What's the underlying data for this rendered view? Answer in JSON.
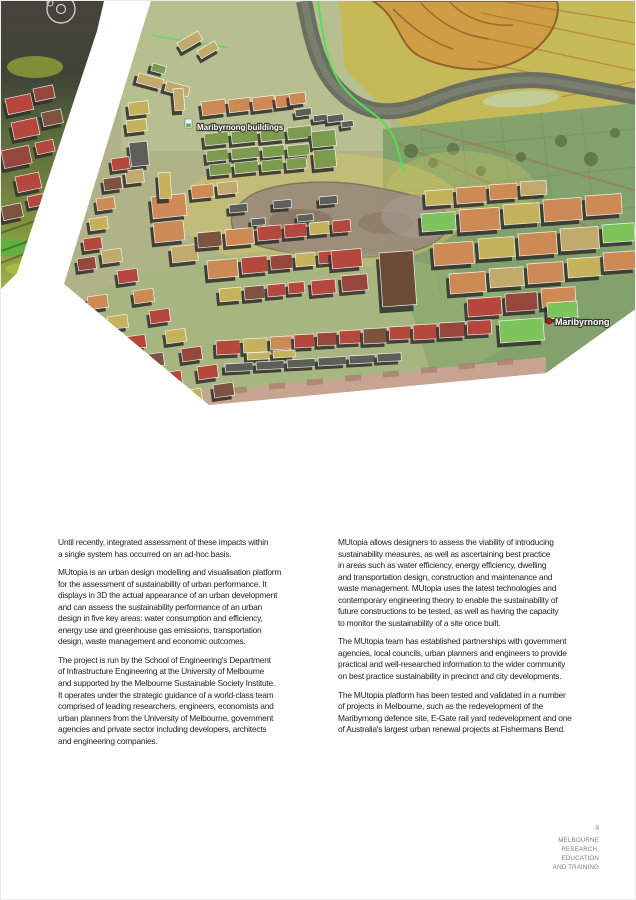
{
  "hero": {
    "labels": [
      {
        "text": "Maribyrnong buildings",
        "x": 196,
        "y": 129,
        "size": 8,
        "icon": "buildings-layer-icon",
        "ix": 184,
        "iy": 118
      },
      {
        "text": "Maribyrnong",
        "x": 554,
        "y": 324,
        "size": 9,
        "icon": "placemark-dot-icon",
        "ix": 548,
        "iy": 320
      }
    ],
    "palette": {
      "or": "#cd8a55",
      "or2": "#d89a66",
      "gr": "#7d9b4f",
      "bg": "#7cc45b",
      "yl": "#c6b25c",
      "rd": "#b5473d",
      "mr": "#94473a",
      "br": "#7d5340",
      "db": "#6b4a38",
      "gy": "#5c5e58",
      "tn": "#c2a96c"
    },
    "buildings": [
      [
        176,
        42,
        24,
        10,
        "tn",
        -30
      ],
      [
        196,
        50,
        20,
        9,
        "tn",
        -30
      ],
      [
        152,
        62,
        14,
        8,
        "gr",
        15
      ],
      [
        138,
        72,
        26,
        10,
        "tn",
        15
      ],
      [
        166,
        80,
        24,
        10,
        "tn",
        15
      ],
      [
        172,
        88,
        10,
        22,
        "tn",
        -5
      ],
      [
        200,
        101,
        24,
        14,
        "or",
        -7
      ],
      [
        227,
        99,
        22,
        13,
        "or",
        -7
      ],
      [
        251,
        97,
        22,
        13,
        "or",
        -7
      ],
      [
        274,
        95,
        20,
        12,
        "or",
        -7
      ],
      [
        288,
        93,
        16,
        11,
        "or",
        -7
      ],
      [
        294,
        109,
        16,
        7,
        "gy",
        -8
      ],
      [
        312,
        115,
        14,
        6,
        "gy",
        -8
      ],
      [
        326,
        115,
        16,
        7,
        "gy",
        -8
      ],
      [
        340,
        121,
        12,
        6,
        "gy",
        -8
      ],
      [
        203,
        133,
        24,
        12,
        "gr",
        -6
      ],
      [
        230,
        131,
        26,
        12,
        "gr",
        -6
      ],
      [
        259,
        129,
        24,
        12,
        "gr",
        -6
      ],
      [
        286,
        127,
        24,
        12,
        "gr",
        -6
      ],
      [
        310,
        131,
        24,
        16,
        "gr",
        -6
      ],
      [
        205,
        150,
        22,
        11,
        "gr",
        -6
      ],
      [
        230,
        148,
        28,
        11,
        "gr",
        -6
      ],
      [
        261,
        146,
        22,
        11,
        "gr",
        -6
      ],
      [
        286,
        145,
        22,
        11,
        "gr",
        -6
      ],
      [
        312,
        150,
        22,
        18,
        "gr",
        -6
      ],
      [
        208,
        164,
        22,
        11,
        "gr",
        -6
      ],
      [
        233,
        162,
        24,
        11,
        "gr",
        -6
      ],
      [
        260,
        160,
        22,
        11,
        "gr",
        -6
      ],
      [
        285,
        158,
        20,
        11,
        "gr",
        -6
      ],
      [
        127,
        102,
        20,
        13,
        "yl",
        -7
      ],
      [
        125,
        120,
        20,
        12,
        "yl",
        -7
      ],
      [
        128,
        142,
        18,
        24,
        "gy",
        -6
      ],
      [
        124,
        170,
        18,
        13,
        "tn",
        -7
      ],
      [
        150,
        196,
        34,
        22,
        "or",
        -6
      ],
      [
        152,
        222,
        30,
        20,
        "or",
        -6
      ],
      [
        157,
        172,
        12,
        26,
        "yl",
        -4
      ],
      [
        170,
        246,
        26,
        16,
        "tn",
        -6
      ],
      [
        190,
        185,
        22,
        13,
        "or",
        -6
      ],
      [
        216,
        182,
        20,
        12,
        "tn",
        -6
      ],
      [
        110,
        158,
        18,
        12,
        "rd",
        -8
      ],
      [
        102,
        178,
        18,
        12,
        "br",
        -8
      ],
      [
        95,
        198,
        18,
        12,
        "or",
        -8
      ],
      [
        88,
        218,
        18,
        12,
        "yl",
        -8
      ],
      [
        82,
        238,
        18,
        12,
        "rd",
        -8
      ],
      [
        76,
        258,
        18,
        12,
        "mr",
        -8
      ],
      [
        86,
        296,
        20,
        13,
        "or",
        -8
      ],
      [
        106,
        316,
        20,
        13,
        "yl",
        -8
      ],
      [
        124,
        336,
        20,
        13,
        "rd",
        -8
      ],
      [
        142,
        354,
        20,
        13,
        "br",
        -8
      ],
      [
        160,
        372,
        20,
        13,
        "rd",
        -8
      ],
      [
        180,
        390,
        20,
        13,
        "yl",
        -8
      ],
      [
        100,
        250,
        20,
        13,
        "tn",
        -8
      ],
      [
        116,
        270,
        20,
        13,
        "rd",
        -8
      ],
      [
        132,
        290,
        20,
        13,
        "or",
        -8
      ],
      [
        148,
        310,
        20,
        13,
        "rd",
        -8
      ],
      [
        164,
        330,
        20,
        13,
        "yl",
        -8
      ],
      [
        180,
        348,
        20,
        13,
        "mr",
        -8
      ],
      [
        196,
        366,
        20,
        13,
        "rd",
        -8
      ],
      [
        212,
        384,
        20,
        13,
        "br",
        -8
      ],
      [
        228,
        204,
        18,
        8,
        "gy",
        -5
      ],
      [
        272,
        200,
        18,
        8,
        "gy",
        -5
      ],
      [
        318,
        196,
        18,
        8,
        "gy",
        -5
      ],
      [
        250,
        218,
        14,
        7,
        "gy",
        -5
      ],
      [
        296,
        214,
        16,
        7,
        "gy",
        -5
      ],
      [
        196,
        232,
        24,
        15,
        "br",
        -5
      ],
      [
        224,
        229,
        28,
        16,
        "or",
        -5
      ],
      [
        256,
        226,
        24,
        14,
        "rd",
        -5
      ],
      [
        283,
        224,
        22,
        13,
        "rd",
        -5
      ],
      [
        308,
        222,
        20,
        12,
        "yl",
        -5
      ],
      [
        331,
        220,
        18,
        12,
        "rd",
        -5
      ],
      [
        206,
        260,
        30,
        18,
        "or",
        -5
      ],
      [
        240,
        257,
        26,
        16,
        "rd",
        -5
      ],
      [
        269,
        255,
        22,
        14,
        "mr",
        -5
      ],
      [
        294,
        253,
        20,
        13,
        "yl",
        -5
      ],
      [
        317,
        251,
        18,
        12,
        "rd",
        -5
      ],
      [
        218,
        288,
        22,
        13,
        "yl",
        -5
      ],
      [
        243,
        286,
        20,
        13,
        "br",
        -5
      ],
      [
        266,
        284,
        18,
        12,
        "rd",
        -5
      ],
      [
        287,
        282,
        16,
        11,
        "rd",
        -5
      ],
      [
        330,
        250,
        30,
        18,
        "rd",
        -5
      ],
      [
        340,
        275,
        26,
        16,
        "mr",
        -5
      ],
      [
        310,
        280,
        24,
        14,
        "rd",
        -5
      ],
      [
        378,
        252,
        34,
        54,
        "db",
        -4
      ],
      [
        424,
        190,
        28,
        15,
        "yl",
        -4
      ],
      [
        455,
        187,
        30,
        16,
        "or",
        -4
      ],
      [
        488,
        184,
        28,
        15,
        "or",
        -4
      ],
      [
        519,
        181,
        26,
        14,
        "tn",
        -4
      ],
      [
        420,
        213,
        34,
        18,
        "bg",
        -4
      ],
      [
        458,
        209,
        40,
        22,
        "or",
        -4
      ],
      [
        502,
        204,
        36,
        20,
        "yl",
        -4
      ],
      [
        542,
        199,
        38,
        22,
        "or",
        -4
      ],
      [
        584,
        195,
        36,
        20,
        "or",
        -4
      ],
      [
        432,
        243,
        40,
        22,
        "or",
        -4
      ],
      [
        477,
        238,
        36,
        20,
        "yl",
        -4
      ],
      [
        517,
        233,
        38,
        22,
        "or",
        -4
      ],
      [
        559,
        228,
        38,
        22,
        "tn",
        -4
      ],
      [
        601,
        224,
        32,
        18,
        "bg",
        -4
      ],
      [
        448,
        273,
        36,
        20,
        "or",
        -4
      ],
      [
        488,
        268,
        34,
        19,
        "tn",
        -4
      ],
      [
        526,
        263,
        36,
        20,
        "or",
        -4
      ],
      [
        566,
        258,
        34,
        19,
        "yl",
        -4
      ],
      [
        602,
        252,
        32,
        18,
        "or",
        -4
      ],
      [
        466,
        298,
        34,
        18,
        "rd",
        -4
      ],
      [
        504,
        293,
        32,
        18,
        "mr",
        -4
      ],
      [
        540,
        288,
        34,
        19,
        "or",
        -4
      ],
      [
        498,
        320,
        44,
        22,
        "bg",
        -4
      ],
      [
        546,
        302,
        30,
        16,
        "bg",
        -4
      ],
      [
        215,
        340,
        24,
        14,
        "rd",
        -3
      ],
      [
        242,
        338,
        24,
        14,
        "yl",
        -3
      ],
      [
        269,
        336,
        22,
        13,
        "or",
        -3
      ],
      [
        293,
        334,
        20,
        13,
        "rd",
        -3
      ],
      [
        316,
        332,
        20,
        13,
        "mr",
        -3
      ],
      [
        338,
        330,
        22,
        13,
        "rd",
        -3
      ],
      [
        362,
        328,
        24,
        15,
        "br",
        -3
      ],
      [
        388,
        326,
        22,
        13,
        "rd",
        -3
      ],
      [
        412,
        324,
        24,
        15,
        "rd",
        -3
      ],
      [
        438,
        322,
        26,
        15,
        "mr",
        -3
      ],
      [
        466,
        320,
        24,
        14,
        "rd",
        -3
      ],
      [
        246,
        352,
        24,
        7,
        "yl",
        -3
      ],
      [
        272,
        350,
        22,
        7,
        "yl",
        -3
      ],
      [
        224,
        363,
        28,
        8,
        "gy",
        -3
      ],
      [
        255,
        361,
        28,
        8,
        "gy",
        -3
      ],
      [
        286,
        359,
        28,
        8,
        "gy",
        -3
      ],
      [
        317,
        357,
        28,
        8,
        "gy",
        -3
      ],
      [
        348,
        355,
        26,
        8,
        "gy",
        -3
      ],
      [
        376,
        353,
        24,
        8,
        "gy",
        -3
      ]
    ],
    "sliver_buildings": [
      [
        4,
        98,
        26,
        16,
        "rd",
        -12
      ],
      [
        32,
        88,
        20,
        13,
        "mr",
        -12
      ],
      [
        10,
        122,
        26,
        17,
        "rd",
        -12
      ],
      [
        40,
        112,
        20,
        14,
        "br",
        -12
      ],
      [
        0,
        150,
        28,
        18,
        "mr",
        -12
      ],
      [
        34,
        142,
        18,
        12,
        "rd",
        -12
      ],
      [
        14,
        176,
        24,
        16,
        "rd",
        -12
      ],
      [
        0,
        206,
        20,
        14,
        "br",
        -12
      ],
      [
        26,
        196,
        16,
        11,
        "rd",
        -12
      ]
    ]
  },
  "article": {
    "left_column": [
      [
        "Until recently, integrated assessment of these impacts within",
        "a single system has occurred on an ad-hoc basis."
      ],
      [
        "MUtopia is an urban design modelling and visualisation platform",
        "for the assessment of sustainability of urban performance. It",
        "displays in 3D the actual appearance of an urban development",
        "and can assess the sustainability performance of an urban",
        "design in five key areas: water consumption and efficiency,",
        "energy use and greenhouse gas emissions, transportation",
        "design, waste management and economic outcomes."
      ],
      [
        "The project is run by the School of Engineering's Department",
        "of Infrastructure Engineering at the University of Melbourne",
        "and supported by the Melbourne Sustainable Society Institute.",
        "It operates under the strategic guidance of a world-class team",
        "comprised of leading researchers, engineers, economists and",
        "urban planners from the University of Melbourne, government",
        "agencies and private sector including developers, architects",
        "and engineering companies."
      ]
    ],
    "right_column": [
      [
        "MUtopia allows designers to assess the viability of introducing",
        "sustainability measures, as well as ascertaining best practice",
        "in areas such as water efficiency, energy efficiency, dwelling",
        "and transportation design, construction and maintenance and",
        "waste management. MUtopia uses the latest technologies and",
        "contemporary engineering theory to enable the sustainability of",
        "future constructions to be tested, as well as having the capacity",
        "to monitor the sustainability of a site once built."
      ],
      [
        "The MUtopia team has established partnerships with government",
        "agencies, local councils, urban planners and engineers to provide",
        "practical and well-researched information to the wider community",
        "on best practice sustainability in precinct and city developments."
      ],
      [
        "The MUtopia platform has been tested and validated in a number",
        "of projects in Melbourne, such as the redevelopment of the",
        "Maribyrnong defence site, E-Gate rail yard redevelopment and one",
        "of Australia's largest urban renewal projects at Fishermans Bend."
      ]
    ]
  },
  "footer": {
    "page_number": "9",
    "brand_lines": [
      "MELBOURNE",
      "RESEARCH,",
      "EDUCATION",
      "AND TRAINING"
    ]
  }
}
